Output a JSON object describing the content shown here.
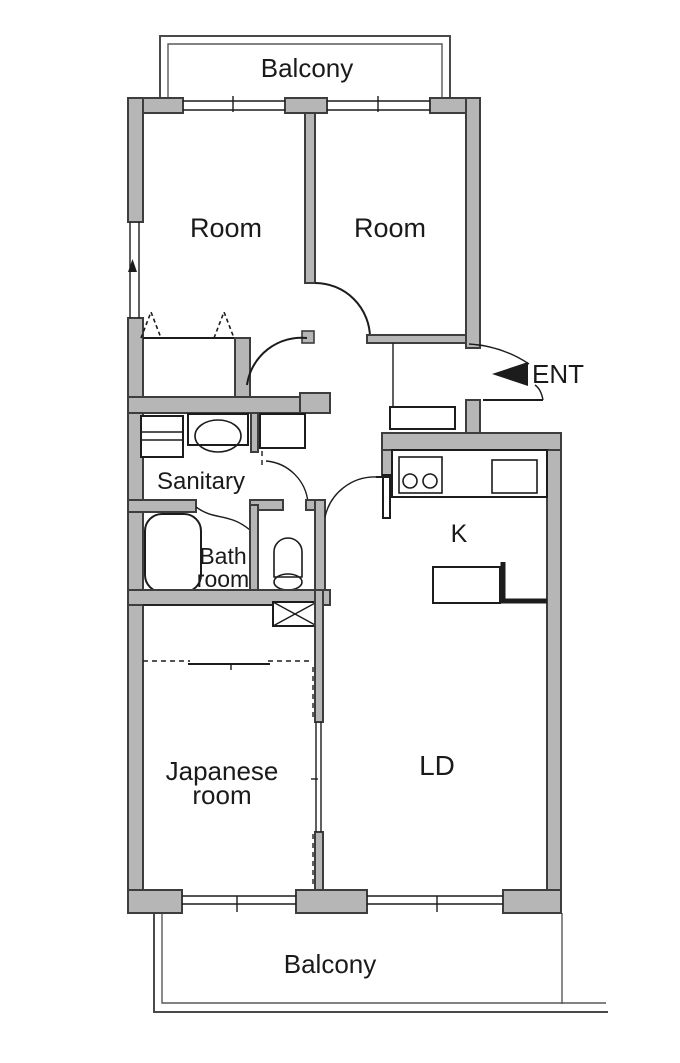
{
  "title": "Apartment floor plan",
  "colors": {
    "bg": "#ffffff",
    "wall_fill": "#b6b6b6",
    "wall_stroke": "#3d3d3d",
    "line": "#1c1c1c",
    "text": "#1a1a1a"
  },
  "labels": {
    "balcony_top": "Balcony",
    "room_left": "Room",
    "room_right": "Room",
    "ent": "ENT",
    "sanitary": "Sanitary",
    "bath_line1": "Bath",
    "bath_line2": "room",
    "kitchen": "K",
    "ld": "LD",
    "japanese_line1": "Japanese",
    "japanese_line2": "room",
    "balcony_bottom": "Balcony"
  }
}
